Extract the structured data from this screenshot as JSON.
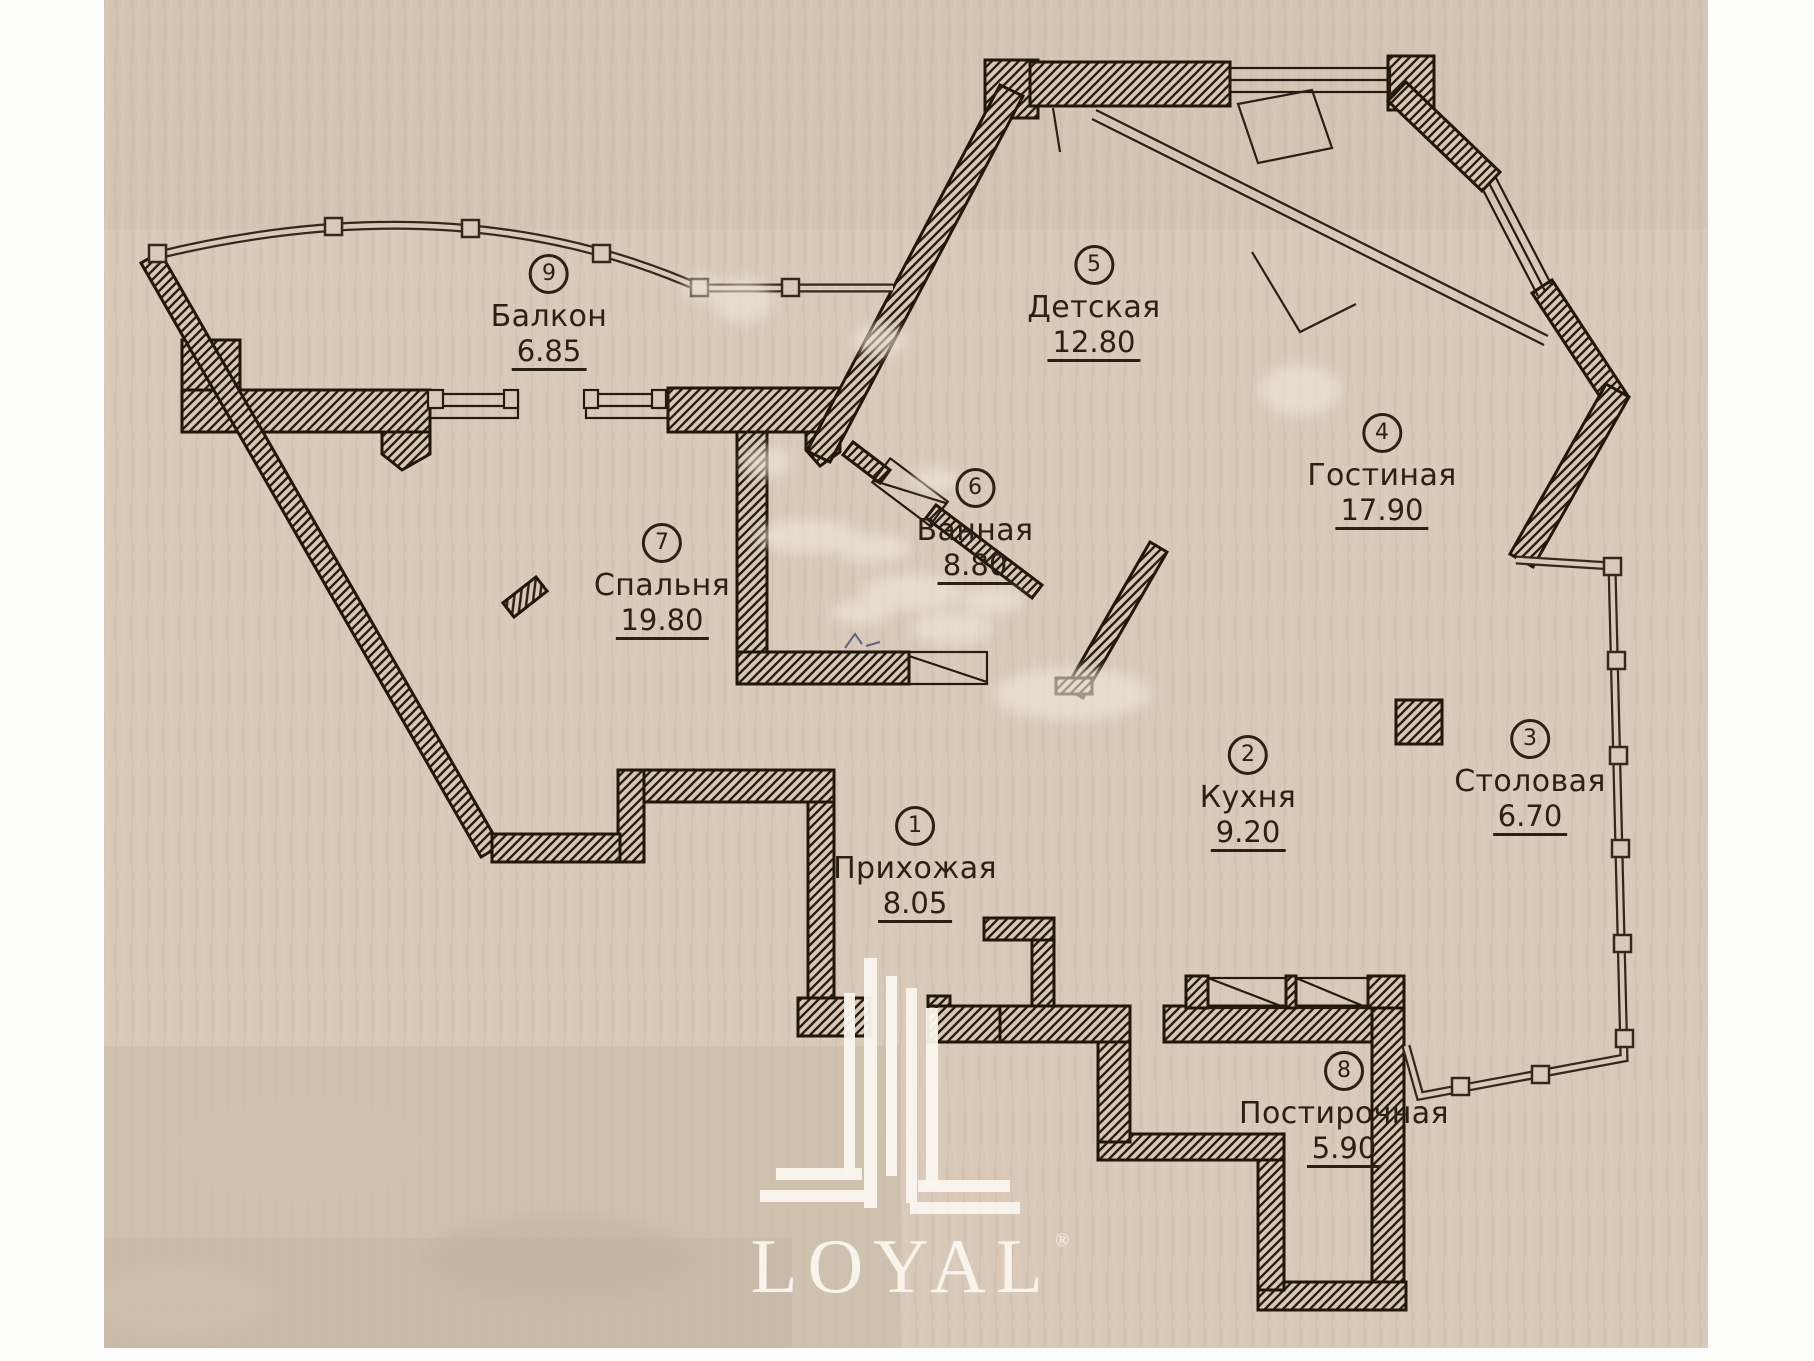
{
  "plan": {
    "kind": "apartment floor plan (scanned)",
    "language": "ru"
  },
  "rooms": [
    {
      "num": "1",
      "name": "Прихожая",
      "area": "8.05"
    },
    {
      "num": "2",
      "name": "Кухня",
      "area": "9.20"
    },
    {
      "num": "3",
      "name": "Столовая",
      "area": "6.70"
    },
    {
      "num": "4",
      "name": "Гостиная",
      "area": "17.90"
    },
    {
      "num": "5",
      "name": "Детская",
      "area": "12.80"
    },
    {
      "num": "6",
      "name": "Ванная",
      "area": "8.80"
    },
    {
      "num": "7",
      "name": "Спальня",
      "area": "19.80"
    },
    {
      "num": "8",
      "name": "Постирочная",
      "area": "5.90"
    },
    {
      "num": "9",
      "name": "Балкон",
      "area": "6.85"
    }
  ],
  "watermark": {
    "text": "LOYAL",
    "reg": "®"
  },
  "colors": {
    "paper": "#d8c9b9",
    "ink": "#261c12",
    "watermark": "#faf6ee"
  }
}
